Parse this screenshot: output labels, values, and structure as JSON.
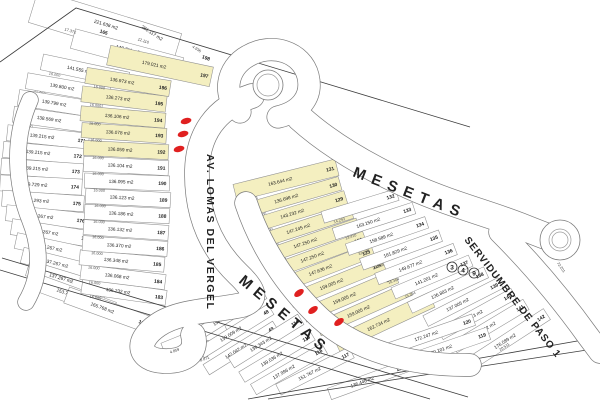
{
  "map": {
    "streets": [
      {
        "id": "av-lomas-del-vergel",
        "name": "AV. LOMAS  DEL VERGEL"
      },
      {
        "id": "mesetas-upper",
        "name": "MESETAS"
      },
      {
        "id": "mesetas-lower",
        "name": "MESETAS"
      },
      {
        "id": "servidumbre-de-paso",
        "name": "SERVIDUMBRE DE PASO 1"
      }
    ],
    "station_marker": "349",
    "red_markers": {
      "count": 6,
      "color": "#e02020"
    },
    "colors": {
      "highlight": "#f4efc0",
      "parcel_line": "#8f8f8f",
      "road_line": "#7a7a7a",
      "boundary": "#3c3c3c",
      "text": "#1c1c1c",
      "background": "#ffffff"
    },
    "floating_dimensions": [
      "12.110",
      "17.372",
      "4.936",
      "72.201",
      "8.871",
      "4.859",
      "20.511"
    ],
    "parcel_groups": [
      {
        "name": "north-west-column",
        "parcels": [
          {
            "lot": "165",
            "area": "221.638 m2"
          },
          {
            "lot": "166",
            "area": "148.711 m2"
          },
          {
            "lot": "167",
            "area": "141.555 m2",
            "dim": "16.000"
          },
          {
            "lot": "168",
            "area": "139.800 m2",
            "dim": "16.000"
          },
          {
            "lot": "169",
            "area": "139.799 m2",
            "dim": "16.000"
          },
          {
            "lot": "170",
            "area": "138.569 m2",
            "dim": "16.000"
          },
          {
            "lot": "171",
            "area": "139.215 m2",
            "dim": "16.000"
          },
          {
            "lot": "172",
            "area": "139.215 m2",
            "dim": "16.000"
          },
          {
            "lot": "173",
            "area": "139.215 m2",
            "dim": "16.000"
          },
          {
            "lot": "174",
            "area": "139.729 m2",
            "dim": "16.000"
          },
          {
            "lot": "175",
            "area": "137.293 m2",
            "dim": "16.000"
          },
          {
            "lot": "176",
            "area": "137.267 m2",
            "dim": "16.000"
          },
          {
            "lot": "177",
            "area": "137.267 m2",
            "dim": "16.000"
          },
          {
            "lot": "178",
            "area": "137.267 m2",
            "dim": "16.000"
          },
          {
            "lot": "179",
            "area": "137.267 m2",
            "dim": "16.000"
          },
          {
            "lot": "180",
            "area": "137.267 m2",
            "dim": "16.000"
          },
          {
            "lot": "181",
            "area": "153.755 m2"
          }
        ]
      },
      {
        "name": "central-column",
        "parcels": [
          {
            "lot": "182",
            "area": "165.768 m2"
          },
          {
            "lot": "183",
            "area": "136.232 m2",
            "dim": "16.000"
          },
          {
            "lot": "184",
            "area": "136.068 m2",
            "dim": "16.000"
          },
          {
            "lot": "185",
            "area": "136.348 m2",
            "dim": "16.000"
          },
          {
            "lot": "186",
            "area": "136.370 m2",
            "dim": "16.000"
          },
          {
            "lot": "187",
            "area": "136.132 m2",
            "dim": "16.000"
          },
          {
            "lot": "188",
            "area": "136.186 m2",
            "dim": "16.000"
          },
          {
            "lot": "189",
            "area": "136.123 m2",
            "dim": "16.000"
          },
          {
            "lot": "190",
            "area": "136.095 m2",
            "dim": "16.000"
          },
          {
            "lot": "191",
            "area": "136.104 m2",
            "dim": "16.000"
          },
          {
            "lot": "192",
            "area": "136.059 m2",
            "dim": "16.000",
            "highlighted": true
          },
          {
            "lot": "193",
            "area": "136.078 m2",
            "dim": "16.000",
            "highlighted": true
          },
          {
            "lot": "194",
            "area": "136.106 m2",
            "dim": "16.000",
            "highlighted": true
          },
          {
            "lot": "195",
            "area": "136.273 m2",
            "dim": "16.000",
            "highlighted": true
          },
          {
            "lot": "196",
            "area": "136.973 m2",
            "dim": "16.000",
            "highlighted": true
          },
          {
            "lot": "197",
            "area": "179.021 m2",
            "highlighted": true
          },
          {
            "lot": "198",
            "area": "281.117 m2"
          }
        ]
      },
      {
        "name": "south-yellow-strip",
        "parcels": [
          {
            "lot": "131",
            "area": "163.644 m2",
            "dim": "17.235",
            "highlighted": true
          },
          {
            "lot": "130",
            "area": "136.698 m2",
            "dim": "18.000",
            "highlighted": true
          },
          {
            "lot": "129",
            "area": "143.232 m2",
            "dim": "18.000",
            "highlighted": true
          },
          {
            "lot": "128",
            "area": "147.245 m2",
            "dim": "19.000",
            "highlighted": true
          },
          {
            "lot": "127",
            "area": "147.250 m2",
            "dim": "19.000",
            "highlighted": true
          },
          {
            "lot": "126",
            "area": "147.250 m2",
            "dim": "19.000",
            "highlighted": true
          },
          {
            "lot": "125",
            "area": "147.636 m2",
            "dim": "19.000",
            "highlighted": true
          },
          {
            "lot": "124",
            "area": "159.005 m2",
            "dim": "10.000",
            "highlighted": true
          },
          {
            "lot": "123",
            "area": "159.005 m2",
            "dim": "10.000",
            "highlighted": true
          },
          {
            "lot": "122",
            "area": "159.005 m2",
            "dim": "10.000",
            "highlighted": true
          },
          {
            "lot": "121",
            "area": "162.734 m2",
            "highlighted": true
          }
        ]
      },
      {
        "name": "south-east-column",
        "parcels": [
          {
            "lot": "132",
            "dim": "14.293"
          },
          {
            "lot": "133",
            "area": "163.150 m2",
            "dim": "13.410"
          },
          {
            "lot": "134",
            "area": "158.589 m2",
            "dim": "31.178"
          },
          {
            "lot": "135",
            "area": "161.829 m2",
            "dim": "20.888"
          },
          {
            "lot": "136",
            "area": "149.677 m2",
            "dim": "16.364"
          },
          {
            "lot": "137",
            "area": "141.201 m2",
            "dim": "15.364"
          },
          {
            "lot": "138",
            "area": "136.883 m2"
          },
          {
            "lot": "139",
            "area": "137.005 m2"
          },
          {
            "lot": "140",
            "area": "137.113 m2"
          },
          {
            "lot": "141",
            "area": "138.112 m2"
          },
          {
            "lot": "142",
            "area": "176.089 m2"
          }
        ]
      },
      {
        "name": "south-row",
        "parcels": [
          {
            "lot": "45",
            "area": "158.624 m2"
          },
          {
            "lot": "47",
            "area": "159.152 m2"
          },
          {
            "lot": "48",
            "area": "139.009 m2"
          },
          {
            "lot": "49",
            "area": "142.042 m2"
          },
          {
            "lot": "114",
            "area": "139.343 m2"
          },
          {
            "lot": "115",
            "area": "139.036 m2"
          },
          {
            "lot": "116",
            "area": "137.996 m2"
          },
          {
            "lot": "117",
            "area": "151.767 m2"
          },
          {
            "lot": "118",
            "area": "136.446 m2"
          },
          {
            "lot": "119",
            "area": "200.101 m2"
          },
          {
            "lot": "120",
            "area": "172.247 m2"
          }
        ]
      }
    ]
  }
}
